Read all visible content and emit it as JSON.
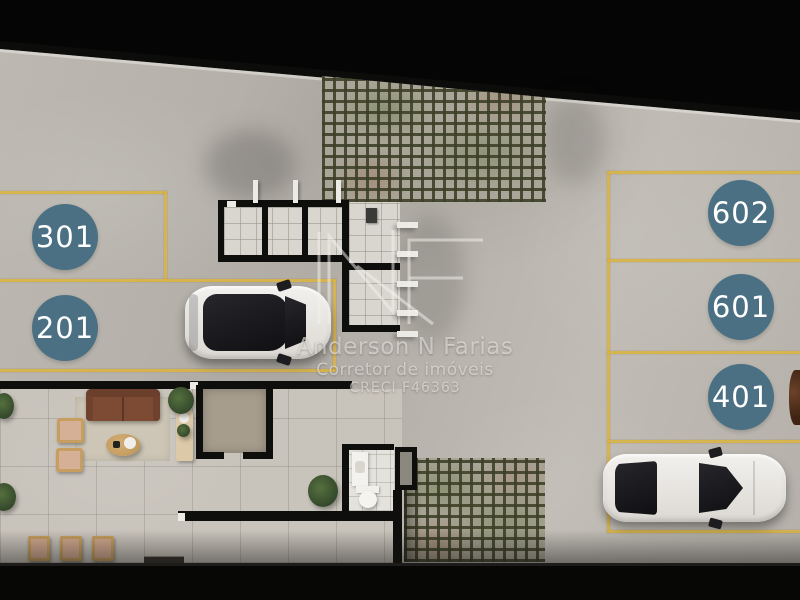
{
  "scene": {
    "type": "parking-garage-floor-plan",
    "badge_color": "#4b7084",
    "line_color": "#d8b44b",
    "floor_color": "#b7b3ac",
    "wall_color": "#0e0e0d"
  },
  "parking": {
    "left_spots": [
      {
        "label": "301"
      },
      {
        "label": "201"
      }
    ],
    "right_spots": [
      {
        "label": "602"
      },
      {
        "label": "601"
      },
      {
        "label": "401"
      }
    ]
  },
  "watermark": {
    "logo": "NF",
    "name": "Anderson N Farias",
    "role": "Corretor de imóveis",
    "license": "CRECI F46363"
  }
}
